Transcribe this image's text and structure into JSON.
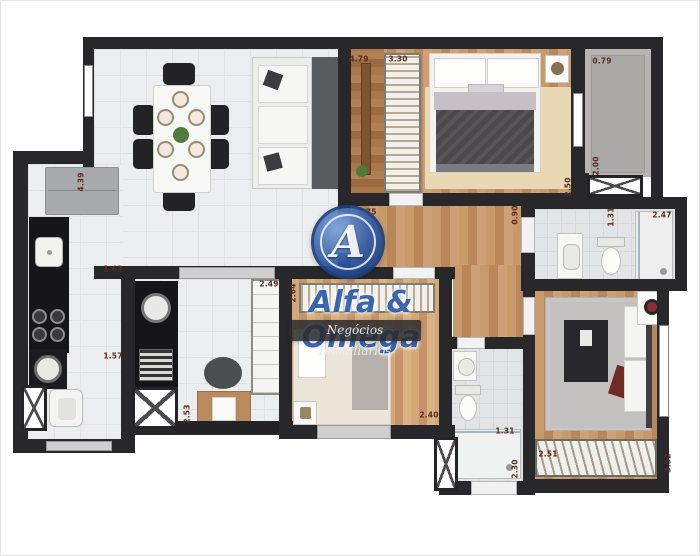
{
  "watermark": {
    "logo_letter": "A",
    "brand": "Alfa & Omega",
    "tagline": "Negócios Imobiliários",
    "brand_color": "#2d5ca8",
    "banner_bg": "#2b2b2d"
  },
  "colors": {
    "wall": "#28282a",
    "tile_floor": "#ecedee",
    "wood_floor": "#c7996b",
    "terrace_floor": "#b6b4b2",
    "bath_floor": "#e3e4e5",
    "dimension_text": "#5a2b24"
  },
  "dimensions": [
    {
      "text": "4.39",
      "x": 80,
      "y": 181,
      "rot": -90
    },
    {
      "text": "1.63",
      "x": 112,
      "y": 268,
      "rot": 0
    },
    {
      "text": "1.57",
      "x": 112,
      "y": 355,
      "rot": 0
    },
    {
      "text": "2.53",
      "x": 186,
      "y": 413,
      "rot": -90
    },
    {
      "text": "2.49",
      "x": 268,
      "y": 283,
      "rot": 0
    },
    {
      "text": "2.64",
      "x": 292,
      "y": 292,
      "rot": -90
    },
    {
      "text": "4.79",
      "x": 358,
      "y": 58,
      "rot": 0
    },
    {
      "text": "3.30",
      "x": 397,
      "y": 58,
      "rot": 0
    },
    {
      "text": "0.79",
      "x": 601,
      "y": 60,
      "rot": 0
    },
    {
      "text": "2.00",
      "x": 595,
      "y": 165,
      "rot": -90
    },
    {
      "text": "2.50",
      "x": 567,
      "y": 186,
      "rot": -90
    },
    {
      "text": "2.75",
      "x": 366,
      "y": 211,
      "rot": 0
    },
    {
      "text": "0.90",
      "x": 514,
      "y": 214,
      "rot": -90
    },
    {
      "text": "1.31",
      "x": 610,
      "y": 216,
      "rot": -90
    },
    {
      "text": "2.47",
      "x": 661,
      "y": 214,
      "rot": 0
    },
    {
      "text": "2.40",
      "x": 428,
      "y": 414,
      "rot": 0
    },
    {
      "text": "1.31",
      "x": 504,
      "y": 430,
      "rot": 0
    },
    {
      "text": "2.30",
      "x": 514,
      "y": 468,
      "rot": -90
    },
    {
      "text": "2.51",
      "x": 547,
      "y": 453,
      "rot": 0
    },
    {
      "text": "3.32",
      "x": 667,
      "y": 462,
      "rot": -90
    }
  ]
}
